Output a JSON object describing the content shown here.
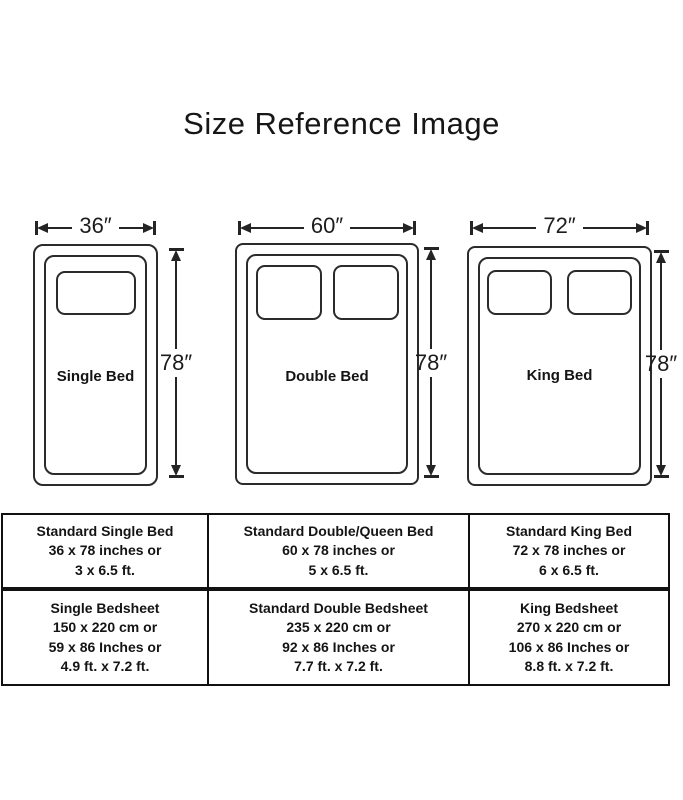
{
  "title": "Size Reference Image",
  "beds": [
    {
      "name": "Single Bed",
      "width_label": "36″",
      "height_label": "78″",
      "pillow_count": 1
    },
    {
      "name": "Double Bed",
      "width_label": "60″",
      "height_label": "78″",
      "pillow_count": 2
    },
    {
      "name": "King Bed",
      "width_label": "72″",
      "height_label": "78″",
      "pillow_count": 2
    }
  ],
  "size_table": {
    "rows": [
      [
        {
          "lines": [
            "Standard Single Bed",
            "36 x 78 inches or",
            "3 x 6.5 ft."
          ]
        },
        {
          "lines": [
            "Standard Double/Queen Bed",
            "60 x 78 inches or",
            "5 x 6.5 ft."
          ]
        },
        {
          "lines": [
            "Standard King Bed",
            "72 x 78 inches or",
            "6 x 6.5 ft."
          ]
        }
      ],
      [
        {
          "lines": [
            "Single Bedsheet",
            "150 x 220 cm or",
            "59 x 86 Inches or",
            "4.9 ft. x 7.2 ft."
          ]
        },
        {
          "lines": [
            "Standard Double Bedsheet",
            "235 x 220 cm or",
            "92 x 86 Inches or",
            "7.7 ft. x 7.2 ft."
          ]
        },
        {
          "lines": [
            "King Bedsheet",
            "270 x 220 cm or",
            "106 x 86 Inches or",
            "8.8 ft. x 7.2 ft."
          ]
        }
      ]
    ]
  },
  "colors": {
    "line": "#2b2b2b",
    "text": "#141414",
    "table_border": "#111111",
    "background": "#ffffff"
  }
}
